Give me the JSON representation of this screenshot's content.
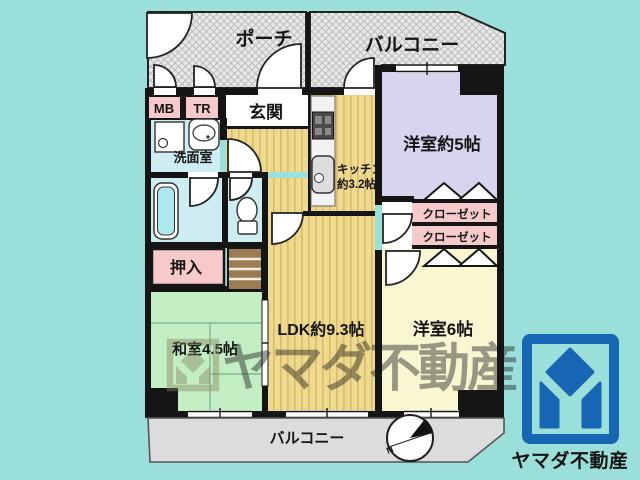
{
  "colors": {
    "background": "#9adfd9",
    "wall": "#151515",
    "hatch_area": "#e8e8e8",
    "yellow_floor": "#eeda8e",
    "lavender_room": "#d7d4ee",
    "cream_room": "#f9f7d2",
    "tatami_room": "#c3eec3",
    "closet_pink": "#f6caca",
    "wet_area_cyan": "#cdedf3",
    "balcony_gray": "#dcdcdc",
    "steps_brown": "#9b7b52",
    "brand_blue": "#1766b3",
    "watermark_olive": "#85825f"
  },
  "plan": {
    "porch_label": "ポーチ",
    "balcony_top_label": "バルコニー",
    "balcony_bottom_label": "バルコニー",
    "mb_label": "MB",
    "tr_label": "TR",
    "entrance_label": "玄関",
    "washroom_label": "洗面室",
    "kitchen_label_line1": "キッチン",
    "kitchen_label_line2": "約3.2帖",
    "western5_label": "洋室約5帖",
    "closet1_label": "クローゼット",
    "closet2_label": "クローゼット",
    "oshiire_label": "押入",
    "washitsu_label": "和室4.5帖",
    "ldk_label": "LDK約9.3帖",
    "western6_label": "洋室6帖",
    "compass_label": "N"
  },
  "watermark": {
    "text": "ヤマダ不動産"
  },
  "brand": {
    "logo_text": "ヤマダ不動産"
  }
}
